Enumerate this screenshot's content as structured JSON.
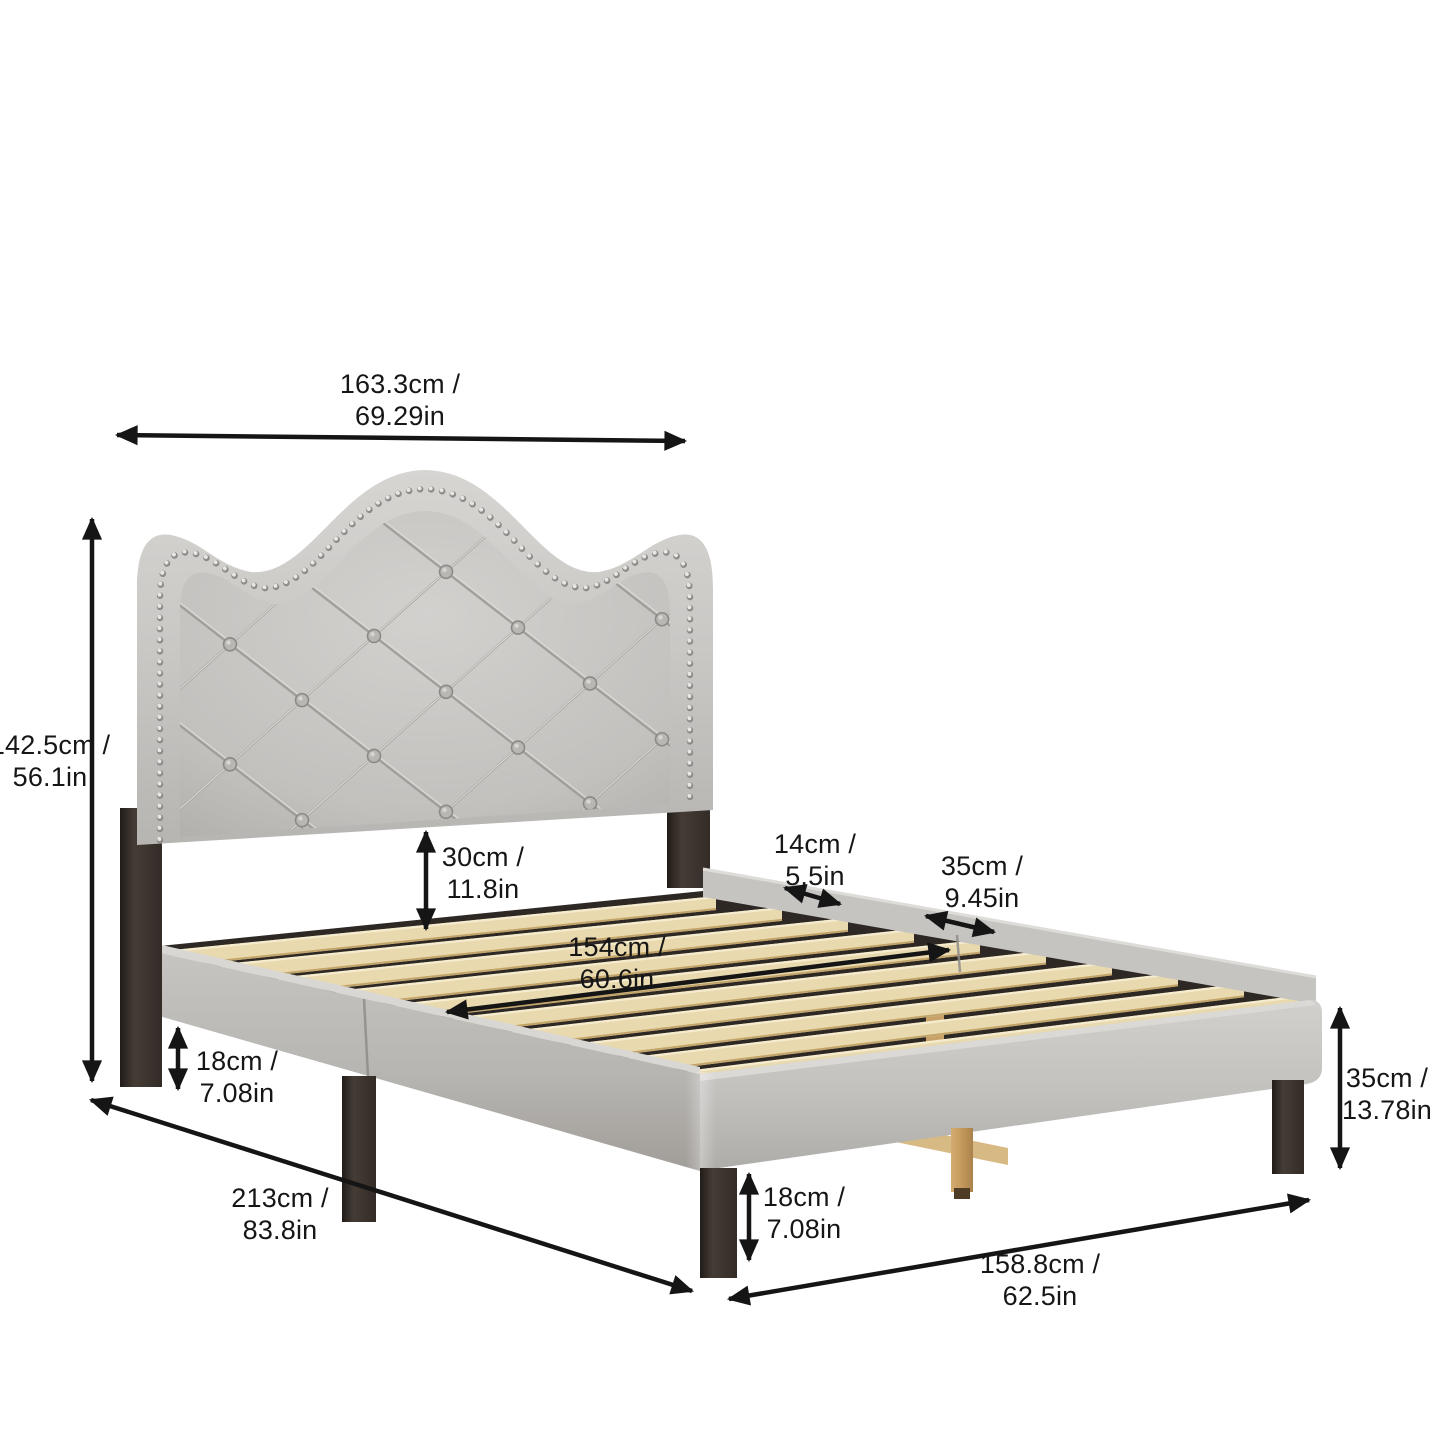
{
  "title": "Upholstered platform bed dimension diagram",
  "product": "Tufted nailhead-trim camelback headboard platform bed with wood slats",
  "colors": {
    "background": "#ffffff",
    "annotation": "#151515",
    "fabric": "#c8c6c3",
    "fabric_shadow": "#aaa8a5",
    "leg_wood_dark": "#372f2a",
    "slat_wood": "#e9d9ae",
    "support_wood": "#c9a269",
    "interior_shadow": "#2d2824",
    "nailhead_silver": "#dddddb"
  },
  "dimensions": [
    {
      "id": "headboard-width",
      "line1": "163.3cm /",
      "line2": "69.29in"
    },
    {
      "id": "overall-height",
      "line1": "142.5cm /",
      "line2": "56.1in"
    },
    {
      "id": "under-headboard-gap",
      "line1": "30cm /",
      "line2": "11.8in"
    },
    {
      "id": "slat-inner-width",
      "line1": "154cm /",
      "line2": "60.6in"
    },
    {
      "id": "side-rail-thickness",
      "line1": "14cm /",
      "line2": "5.5in"
    },
    {
      "id": "foot-rail-height",
      "line1": "35cm /",
      "line2": "9.45in"
    },
    {
      "id": "head-leg-height",
      "line1": "18cm /",
      "line2": "7.08in"
    },
    {
      "id": "overall-length",
      "line1": "213cm /",
      "line2": "83.8in"
    },
    {
      "id": "foot-leg-height",
      "line1": "18cm /",
      "line2": "7.08in"
    },
    {
      "id": "overall-width",
      "line1": "158.8cm /",
      "line2": "62.5in"
    },
    {
      "id": "platform-total-height",
      "line1": "35cm /",
      "line2": "13.78in"
    }
  ]
}
